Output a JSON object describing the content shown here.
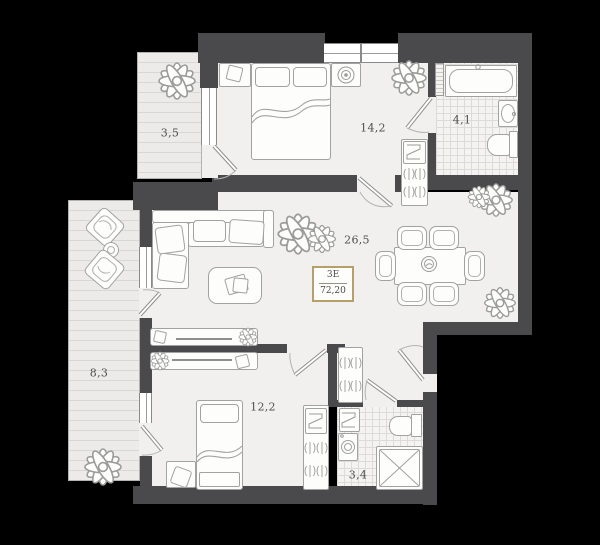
{
  "plan": {
    "badge": {
      "code": "3Е",
      "area": "72,20"
    },
    "rooms": {
      "balcony_top": {
        "label": "3,5"
      },
      "bedroom_main": {
        "label": "14,2"
      },
      "bathroom_main": {
        "label": "4,1"
      },
      "living": {
        "label": "26,5"
      },
      "balcony_side": {
        "label": "8,3"
      },
      "bedroom_second": {
        "label": "12,2"
      },
      "bathroom_second": {
        "label": "3,4"
      }
    },
    "colors": {
      "background": "#000000",
      "wall": "#4a4a4c",
      "floor": "#f1f0ee",
      "floor_balcony": "#ecebe9",
      "tile_line": "#dcdbd8",
      "line": "#9b9b99",
      "accent": "#b5a06a",
      "text": "#4f4f4d"
    }
  }
}
